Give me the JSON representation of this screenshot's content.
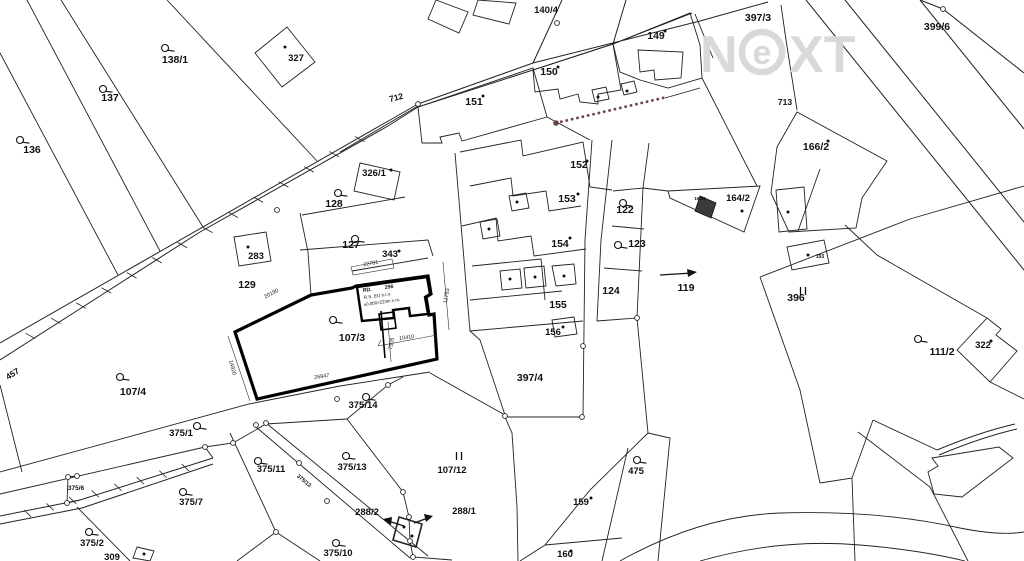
{
  "app": {
    "type": "cadastral-map",
    "watermark": {
      "n": "N",
      "e": "e",
      "xt": "XT"
    }
  },
  "colors": {
    "line": "#222222",
    "bold_outline": "#000000",
    "watermark": "#d8d8d8",
    "boundary_dots": "#6b4242",
    "background": "#ffffff"
  },
  "labels": [
    {
      "t": "136",
      "x": 32,
      "y": 153
    },
    {
      "t": "137",
      "x": 110,
      "y": 101
    },
    {
      "t": "138/1",
      "x": 175,
      "y": 63
    },
    {
      "t": "327",
      "x": 296,
      "y": 61,
      "s": 9.5
    },
    {
      "t": "283",
      "x": 256,
      "y": 259,
      "s": 9.5
    },
    {
      "t": "129",
      "x": 247,
      "y": 288
    },
    {
      "t": "128",
      "x": 334,
      "y": 207
    },
    {
      "t": "127",
      "x": 351,
      "y": 248
    },
    {
      "t": "326/1",
      "x": 374,
      "y": 176,
      "s": 9.5
    },
    {
      "t": "343",
      "x": 390,
      "y": 257,
      "s": 9.5
    },
    {
      "t": "107/3",
      "x": 352,
      "y": 341
    },
    {
      "t": "107/4",
      "x": 133,
      "y": 395
    },
    {
      "t": "457",
      "x": 8,
      "y": 380,
      "r": -32,
      "s": 8.5,
      "a": "s"
    },
    {
      "t": "712",
      "x": 390,
      "y": 102,
      "r": -14,
      "s": 8.5,
      "a": "s"
    },
    {
      "t": "140/4",
      "x": 546,
      "y": 13,
      "s": 9.5
    },
    {
      "t": "151",
      "x": 474,
      "y": 105
    },
    {
      "t": "150",
      "x": 549,
      "y": 75
    },
    {
      "t": "149",
      "x": 656,
      "y": 39
    },
    {
      "t": "397/3",
      "x": 758,
      "y": 21
    },
    {
      "t": "399/6",
      "x": 937,
      "y": 30
    },
    {
      "t": "713",
      "x": 785,
      "y": 105,
      "s": 8.5
    },
    {
      "t": "166/2",
      "x": 816,
      "y": 150
    },
    {
      "t": "152",
      "x": 579,
      "y": 168
    },
    {
      "t": "153",
      "x": 567,
      "y": 202
    },
    {
      "t": "154",
      "x": 560,
      "y": 247
    },
    {
      "t": "122",
      "x": 625,
      "y": 213
    },
    {
      "t": "123",
      "x": 637,
      "y": 247
    },
    {
      "t": "124",
      "x": 611,
      "y": 294
    },
    {
      "t": "155",
      "x": 558,
      "y": 308
    },
    {
      "t": "156",
      "x": 553,
      "y": 335,
      "s": 9.5
    },
    {
      "t": "164/2",
      "x": 738,
      "y": 201,
      "s": 9.5
    },
    {
      "t": "164/4",
      "x": 700,
      "y": 200,
      "s": 4.5
    },
    {
      "t": "119",
      "x": 686,
      "y": 291
    },
    {
      "t": "396",
      "x": 796,
      "y": 301
    },
    {
      "t": "193",
      "x": 820,
      "y": 258,
      "s": 5
    },
    {
      "t": "111/2",
      "x": 942,
      "y": 355
    },
    {
      "t": "322",
      "x": 983,
      "y": 348,
      "s": 9.5
    },
    {
      "t": "397/4",
      "x": 530,
      "y": 381
    },
    {
      "t": "475",
      "x": 636,
      "y": 474,
      "s": 9.5
    },
    {
      "t": "159",
      "x": 581,
      "y": 505,
      "s": 9.5
    },
    {
      "t": "160",
      "x": 565,
      "y": 557,
      "s": 9.5
    },
    {
      "t": "375/1",
      "x": 181,
      "y": 436,
      "s": 9.5
    },
    {
      "t": "375/14",
      "x": 363,
      "y": 408,
      "s": 9.5
    },
    {
      "t": "375/6",
      "x": 76,
      "y": 490,
      "s": 6.5
    },
    {
      "t": "375/7",
      "x": 191,
      "y": 505,
      "s": 9.5
    },
    {
      "t": "375/11",
      "x": 271,
      "y": 472,
      "s": 9.5
    },
    {
      "t": "375/12",
      "x": 303,
      "y": 482,
      "r": 40,
      "s": 5.5
    },
    {
      "t": "375/13",
      "x": 352,
      "y": 470,
      "s": 9.5
    },
    {
      "t": "375/2",
      "x": 92,
      "y": 546,
      "s": 9.5
    },
    {
      "t": "375/10",
      "x": 338,
      "y": 556,
      "s": 9.5
    },
    {
      "t": "309",
      "x": 112,
      "y": 560,
      "s": 9.5
    },
    {
      "t": "288/2",
      "x": 367,
      "y": 515,
      "s": 9.5
    },
    {
      "t": "288/1",
      "x": 464,
      "y": 514,
      "s": 9.5
    },
    {
      "t": "107/12",
      "x": 452,
      "y": 473,
      "s": 9.5
    },
    {
      "t": "20190",
      "x": 272,
      "y": 295,
      "r": -27,
      "c": "dim"
    },
    {
      "t": "26847",
      "x": 322,
      "y": 378,
      "r": -8,
      "c": "dim"
    },
    {
      "t": "14920",
      "x": 231,
      "y": 368,
      "r": 75,
      "c": "dim"
    },
    {
      "t": "22781",
      "x": 371,
      "y": 265,
      "r": -10,
      "c": "dim"
    },
    {
      "t": "11753",
      "x": 448,
      "y": 296,
      "r": -80,
      "c": "dim"
    },
    {
      "t": "10410",
      "x": 407,
      "y": 339,
      "r": -8,
      "c": "dim"
    },
    {
      "t": "7505",
      "x": 393,
      "y": 344,
      "r": -80,
      "c": "dim"
    },
    {
      "t": "RD.",
      "x": 363,
      "y": 292,
      "r": -8,
      "s": 5.2,
      "a": "s"
    },
    {
      "t": "296",
      "x": 385,
      "y": 289,
      "r": -8,
      "s": 5.2,
      "a": "s"
    },
    {
      "t": "R.S. EU s.r.o.",
      "x": 364,
      "y": 299,
      "r": -8,
      "s": 4.6,
      "a": "s",
      "b": 0
    },
    {
      "t": "±0,000=223m n.m.",
      "x": 364,
      "y": 306,
      "r": -8,
      "s": 4.4,
      "a": "s",
      "b": 0
    }
  ],
  "symbols": {
    "landuse": [
      [
        20,
        140
      ],
      [
        103,
        89
      ],
      [
        165,
        48
      ],
      [
        338,
        193
      ],
      [
        355,
        239
      ],
      [
        333,
        320
      ],
      [
        120,
        377
      ],
      [
        197,
        426
      ],
      [
        366,
        397
      ],
      [
        258,
        461
      ],
      [
        346,
        456
      ],
      [
        183,
        492
      ],
      [
        89,
        532
      ],
      [
        336,
        543
      ],
      [
        623,
        203
      ],
      [
        618,
        245
      ],
      [
        918,
        339
      ],
      [
        637,
        460
      ]
    ],
    "survey_circles": [
      [
        418,
        104
      ],
      [
        557,
        23
      ],
      [
        943,
        9
      ],
      [
        277,
        210
      ],
      [
        505,
        416
      ],
      [
        582,
        417
      ],
      [
        583,
        346
      ],
      [
        637,
        318
      ],
      [
        388,
        385
      ],
      [
        337,
        399
      ],
      [
        256,
        425
      ],
      [
        266,
        423
      ],
      [
        205,
        447
      ],
      [
        233,
        443
      ],
      [
        299,
        463
      ],
      [
        327,
        501
      ],
      [
        276,
        532
      ],
      [
        68,
        477
      ],
      [
        77,
        476
      ],
      [
        67,
        503
      ],
      [
        403,
        492
      ],
      [
        409,
        517
      ],
      [
        410,
        541
      ],
      [
        413,
        557
      ]
    ],
    "building_dots": [
      [
        285,
        47
      ],
      [
        248,
        247
      ],
      [
        391,
        170
      ],
      [
        399,
        251
      ],
      [
        483,
        96
      ],
      [
        558,
        67
      ],
      [
        665,
        31
      ],
      [
        587,
        161
      ],
      [
        578,
        194
      ],
      [
        570,
        238
      ],
      [
        563,
        327
      ],
      [
        598,
        97
      ],
      [
        627,
        91
      ],
      [
        517,
        202
      ],
      [
        489,
        229
      ],
      [
        510,
        279
      ],
      [
        535,
        277
      ],
      [
        564,
        276
      ],
      [
        828,
        141
      ],
      [
        742,
        211
      ],
      [
        788,
        212
      ],
      [
        808,
        255
      ],
      [
        991,
        341
      ],
      [
        591,
        498
      ],
      [
        571,
        551
      ],
      [
        144,
        554
      ],
      [
        404,
        527
      ],
      [
        412,
        536
      ]
    ],
    "grass_marks": [
      [
        803,
        291
      ],
      [
        459,
        456
      ]
    ]
  }
}
